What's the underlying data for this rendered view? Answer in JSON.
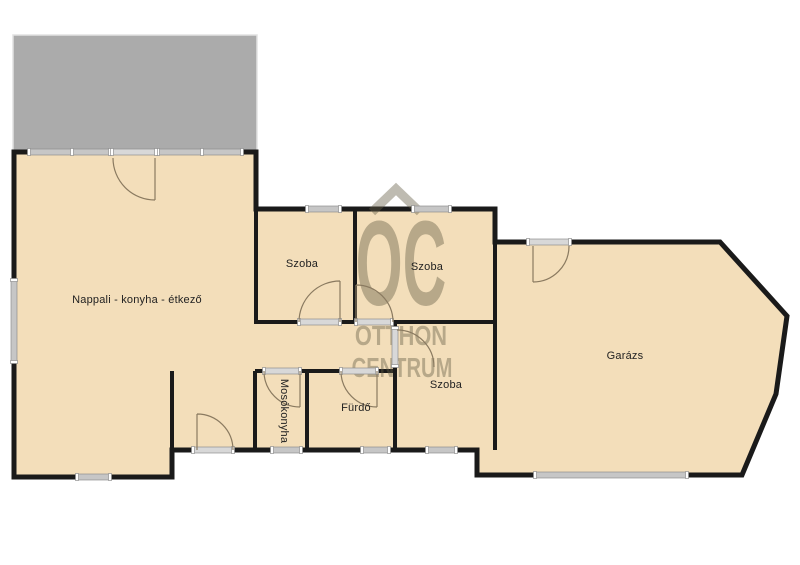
{
  "watermark": {
    "monogram": "OC",
    "line1": "OTTHON",
    "line2": "CENTRUM",
    "roof_icon": "house-roof-icon"
  },
  "rooms": {
    "living": {
      "label": "Nappali - konyha - étkező"
    },
    "room1": {
      "label": "Szoba"
    },
    "room2": {
      "label": "Szoba"
    },
    "room3": {
      "label": "Szoba"
    },
    "bath": {
      "label": "Fürdő"
    },
    "laundry": {
      "label": "Mosókonyha"
    },
    "garage": {
      "label": "Garázs"
    }
  },
  "colors": {
    "floor": "#f3deba",
    "wall": "#1a1a1a",
    "terrace": "#ababab",
    "window-fill": "#c6c6c6",
    "door-fill": "#d8d8d8",
    "frame-edge": "#8f8f8f",
    "swing": "#8a7a60",
    "watermark": "rgba(101,92,70,0.42)",
    "label": "#222222"
  }
}
